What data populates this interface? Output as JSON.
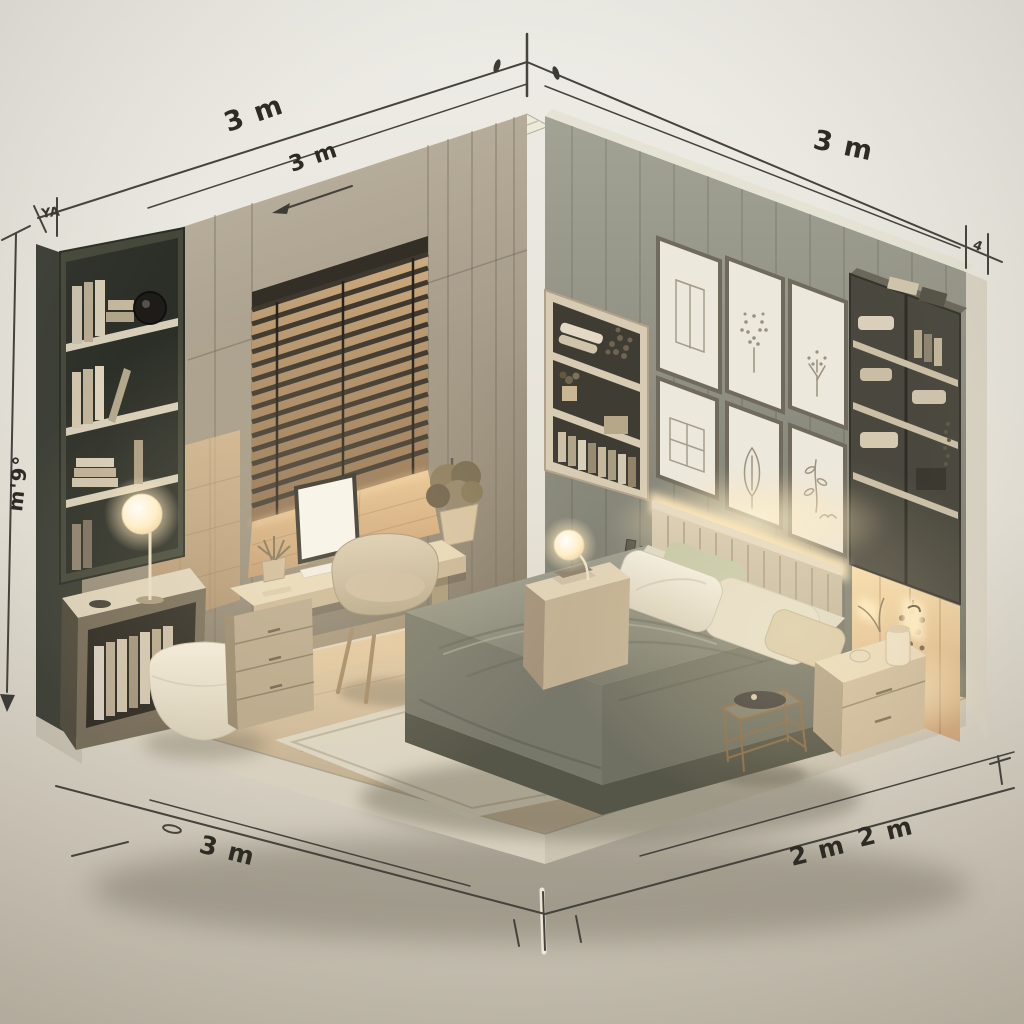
{
  "scene": {
    "description": "Isometric cutaway rendering of a furnished bedroom with dimension lines",
    "style": "warm minimalist 3D render"
  },
  "dimension_labels": {
    "top_left_primary": "3 m",
    "top_left_secondary": "3 m",
    "top_right": "3 m",
    "left_vertical": "m'9°",
    "left_top_tick": "YA",
    "right_top_tick": "4",
    "bottom_left": "3 m",
    "bottom_right_inner": "2 m",
    "bottom_right_outer": "2 m"
  },
  "colors": {
    "background_top": "#ecece6",
    "background_bottom": "#c2bcad",
    "wall_left_dark": "#3a3d34",
    "wall_back_left": "#b2a896",
    "wall_back_right": "#8f8f82",
    "floor_warm": "#c9b596",
    "glow_warm": "#ffdfae",
    "bed_duvet": "#8d8d7f",
    "bed_base": "#5c5c52",
    "headboard": "#cfc2ab",
    "rug": "#dcd5c3",
    "dimension_line": "#45433c",
    "label_text": "#2d2b24"
  },
  "furniture": [
    "left-bookshelf",
    "side-cabinet",
    "floor-lamp",
    "pouf",
    "window-blinds",
    "desk",
    "monitor",
    "keyboard",
    "mouse",
    "desk-plants",
    "drawer-unit",
    "desk-chair",
    "wardrobe",
    "corner-shelf",
    "gallery-wall-frames",
    "right-shelf-unit",
    "lit-closet-panel",
    "headboard",
    "bed",
    "pillows",
    "nightstand-left",
    "nightstand-right",
    "reading-lamp",
    "wall-sconce",
    "glass-side-table",
    "rug"
  ]
}
